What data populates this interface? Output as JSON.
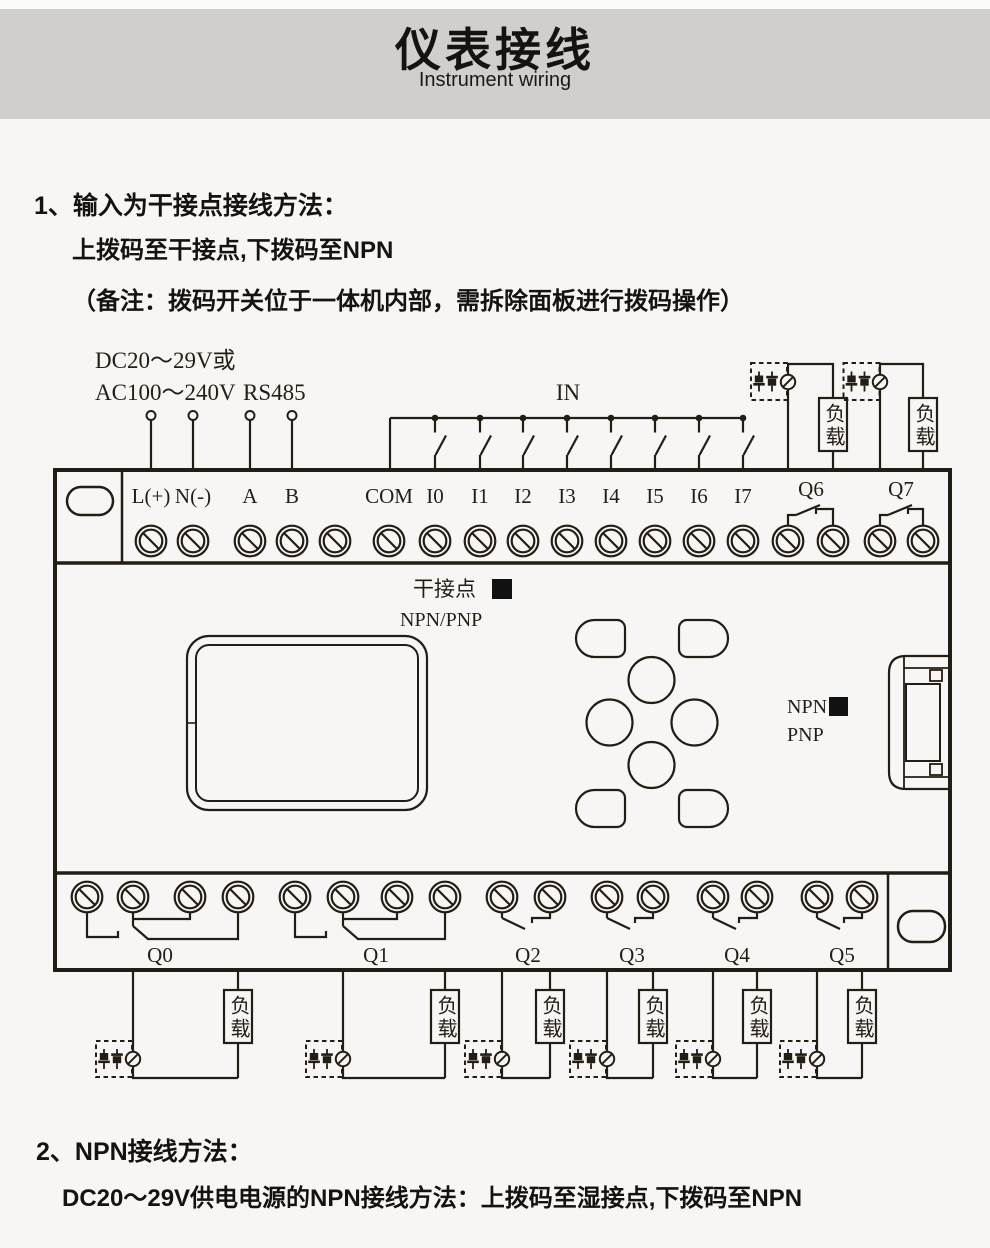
{
  "colors": {
    "page_bg": "#f7f6f4",
    "header_bg": "#d0cfce",
    "ink": "#241d15"
  },
  "header": {
    "title": "仪表接线",
    "subtitle": "Instrument wiring"
  },
  "section1": {
    "heading": "1、输入为干接点接线方法：",
    "line2": "上拨码至干接点,下拨码至NPN",
    "line3": "（备注：拨码开关位于一体机内部，需拆除面板进行拨码操作）"
  },
  "section2": {
    "heading": "2、NPN接线方法：",
    "line2": "DC20～29V供电电源的NPN接线方法：上拨码至湿接点,下拨码至NPN"
  },
  "diagram": {
    "power_line1": "DC20～29V或",
    "power_line2": "AC100～240V",
    "rs485": "RS485",
    "in_label": "IN",
    "terminals_left": [
      "L(+)",
      "N(-)",
      "A",
      "B"
    ],
    "terminals_in": [
      "COM",
      "I0",
      "I1",
      "I2",
      "I3",
      "I4",
      "I5",
      "I6",
      "I7"
    ],
    "outputs_top": [
      "Q6",
      "Q7"
    ],
    "outputs_bottom": [
      "Q0",
      "Q1",
      "Q2",
      "Q3",
      "Q4",
      "Q5"
    ],
    "load": "负载",
    "dry_contact": "干接点",
    "npn_pnp": "NPN/PNP",
    "npn": "NPN",
    "pnp": "PNP"
  }
}
